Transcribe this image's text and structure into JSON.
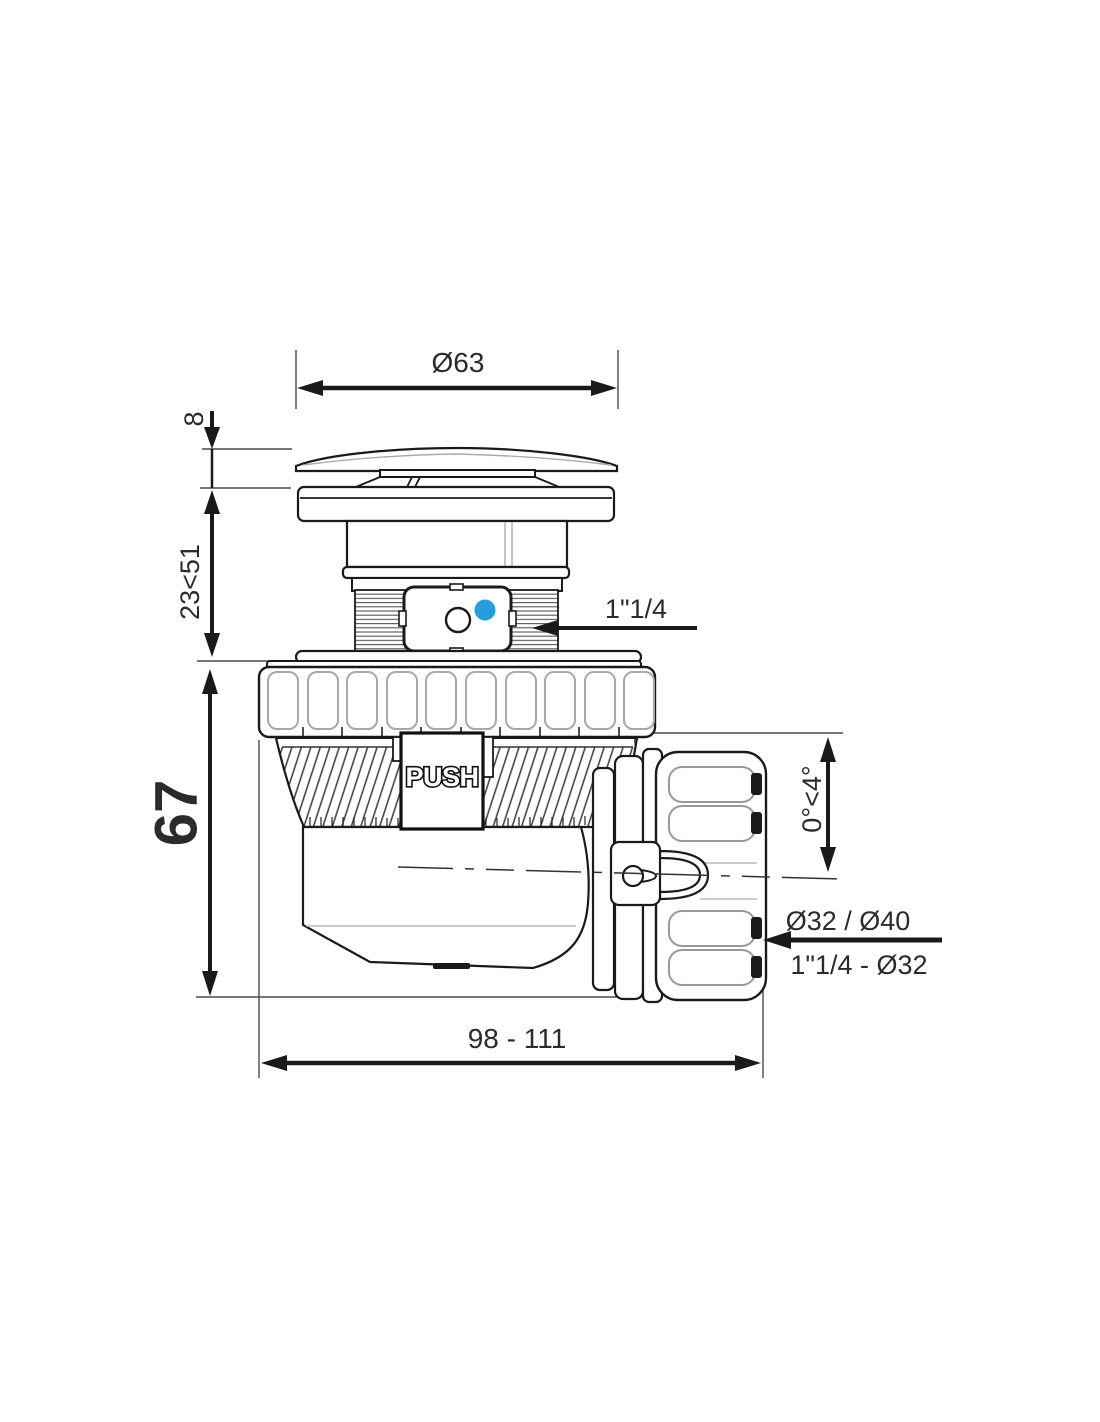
{
  "colors": {
    "accent": "#239fdc",
    "ink": "#1a1a1a"
  },
  "dims": {
    "cap_diameter": "Ø63",
    "cap_height": "8",
    "install_range": "23<51",
    "body_height": "67",
    "inlet_thread": "1\"1/4",
    "outlet_angle": "0°<4°",
    "outlet_diameters": "Ø32 / Ø40",
    "outlet_reduction": "1\"1/4 - Ø32",
    "length_range": "98 - 111"
  },
  "body": {
    "push_label": "PUSH"
  }
}
